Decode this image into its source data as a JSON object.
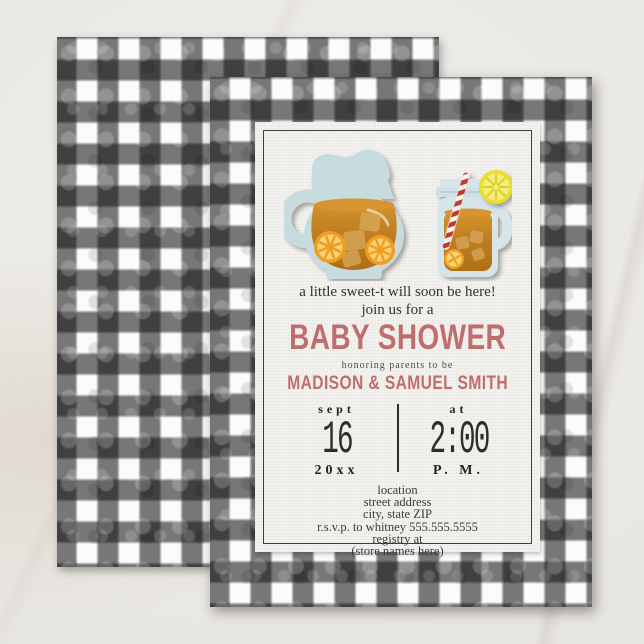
{
  "scene": {
    "surface": "light-marble-table",
    "cards": [
      "gingham-back-card",
      "invitation-front-card"
    ]
  },
  "colors": {
    "accent": "#bf6e6e",
    "ink": "#3a3a3a",
    "panel": "#f3f2ef",
    "marble": "#e9e7e3",
    "gingham_band": "#191919",
    "pitcher_blue": "#c8dce0",
    "jar_blue": "#d6e5e9",
    "tea": "#c07f20",
    "tea_light": "#d6952f",
    "tea_dark": "#b06f17",
    "ice": "#d9ab62",
    "orange_rind": "#ef9c24",
    "orange_flesh": "#f9d477",
    "lemon_rind": "#e8de2f",
    "lemon_flesh": "#f4ec7d",
    "straw_red": "#c23b30"
  },
  "icons": {
    "pitcher": "sweet-tea-pitcher-icon",
    "mason_jar": "mason-jar-mug-icon",
    "lemon": "lemon-slice-icon",
    "straw": "striped-straw-icon"
  },
  "invitation": {
    "intro_line": "a little sweet-t will soon be here!",
    "join_line": "join us for a",
    "title": "BABY SHOWER",
    "subtitle": "honoring parents to be",
    "names": "MADISON & SAMUEL SMITH",
    "date": {
      "month_label": "sept",
      "day": "16",
      "year": "20xx"
    },
    "time": {
      "label": "at",
      "value": "2:00",
      "meridiem": "P. M."
    },
    "details": [
      "location",
      "street address",
      "city, state ZIP",
      "r.s.v.p. to whitney 555.555.5555",
      "registry at",
      "(store names here)"
    ]
  }
}
